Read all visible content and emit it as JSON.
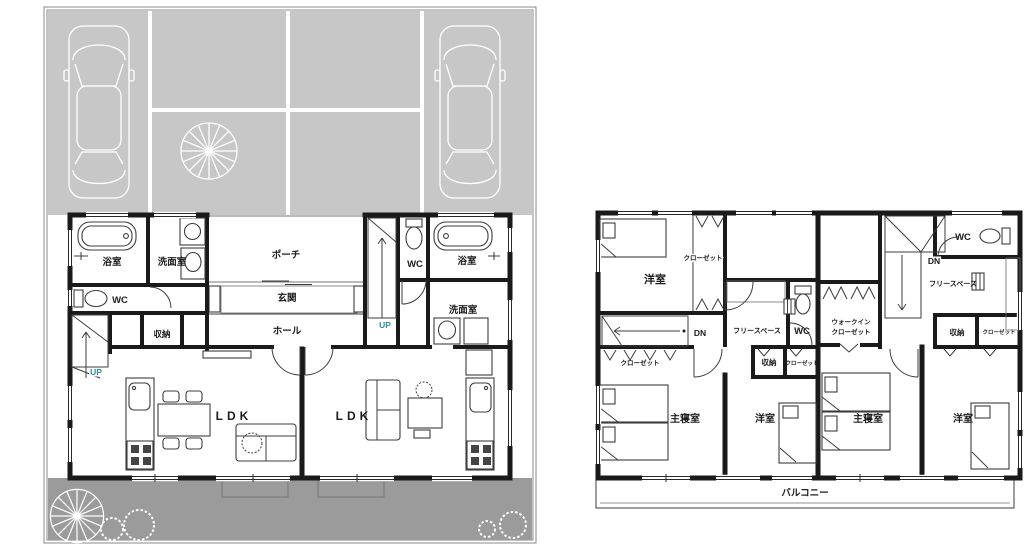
{
  "floor1": {
    "bath_left": "浴室",
    "wash_left": "洗面室",
    "wc_left": "WC",
    "storage_left": "収納",
    "up_left": "UP",
    "porch": "ポーチ",
    "genkan": "玄関",
    "hall": "ホール",
    "up_right": "UP",
    "wc_right": "WC",
    "bath_right": "浴室",
    "wash_right": "洗面室",
    "ldk_left": "LDK",
    "ldk_right": "LDK"
  },
  "floor2": {
    "bedroom_top_left": "洋室",
    "closet_top_left": "クローゼット",
    "dn_left": "DN",
    "free_space_left": "フリースペース",
    "wc_left": "WC",
    "walkin_line1": "ウォークイン",
    "walkin_line2": "クローゼット",
    "dn_right": "DN",
    "free_space_right": "フリースペース",
    "wc_right": "WC",
    "storage_right": "収納",
    "closet_right": "クローゼット",
    "closet_mid_left": "クローゼット",
    "storage_mid": "収納",
    "closet_mid_right": "クローゼット",
    "master_left": "主寝室",
    "bedroom_mid_left": "洋室",
    "master_right": "主寝室",
    "bedroom_right": "洋室",
    "balcony": "バルコニー"
  },
  "colors": {
    "parking_area": "#c7c7c7",
    "garden_area": "#9b9b9b",
    "walls": "#1a1a1a",
    "up_text": "#2e8f96"
  }
}
